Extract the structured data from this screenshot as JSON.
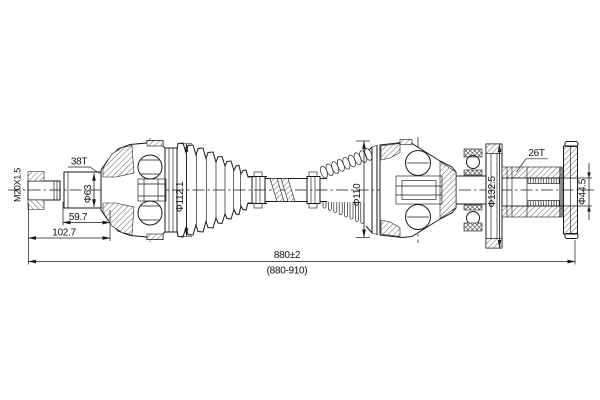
{
  "drawing": {
    "type_note": "cv-axle-drive-shaft-section-drawing",
    "colors": {
      "line": "#1a1a1a",
      "background": "#ffffff"
    },
    "labels": {
      "thread_spec": "M20X1.5",
      "outer_spline_teeth": "38T",
      "inner_spline_teeth": "26T"
    },
    "diameters": {
      "shaft": "Φ63",
      "outer_boot": "Φ112.1",
      "inner_joint": "Φ110",
      "flange_disc": "Φ132.5",
      "spline_bore": "Φ44.5"
    },
    "lengths": {
      "shaft_section": "59.7",
      "to_joint": "102.7",
      "overall": "880±2",
      "overall_range": "(880-910)"
    }
  }
}
